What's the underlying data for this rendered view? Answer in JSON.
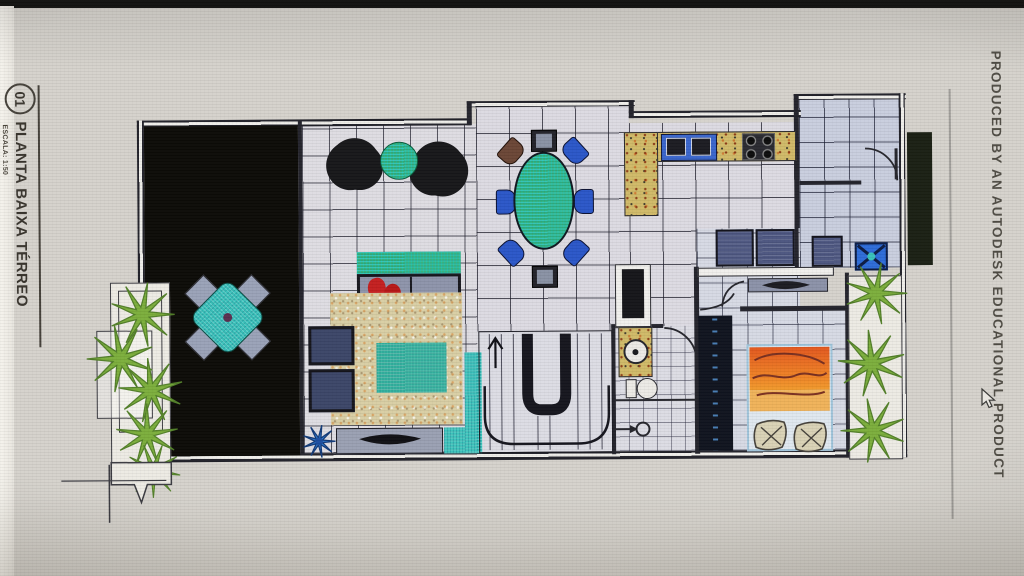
{
  "title_block": {
    "sheet_number": "01",
    "title": "PLANTA BAIXA TÉRREO",
    "scale_label": "ESCALA: 1:50"
  },
  "watermark": {
    "text": "PRODUCED BY AN AUTODESK EDUCATIONAL PRODUCT"
  },
  "cursor": {
    "x": 982,
    "y": 388
  },
  "palette": {
    "screen_bg": "#d5d2cc",
    "paper": "#dedce2",
    "wall": "#22222a",
    "deck_black": "#0c0b07",
    "teal_accent": "#2fbdb6",
    "table_green": "#36a878",
    "chair_blue": "#2b57c8",
    "counter_speckle": "#d0ba68",
    "blanket_orange": "#e8752a",
    "plant_green": "#7cae3c",
    "appliance_navy": "#4c5680",
    "rug_beige": "#d8cea4",
    "tank_blue": "#2e6cd8",
    "sofa_gray": "#8e94aa"
  }
}
